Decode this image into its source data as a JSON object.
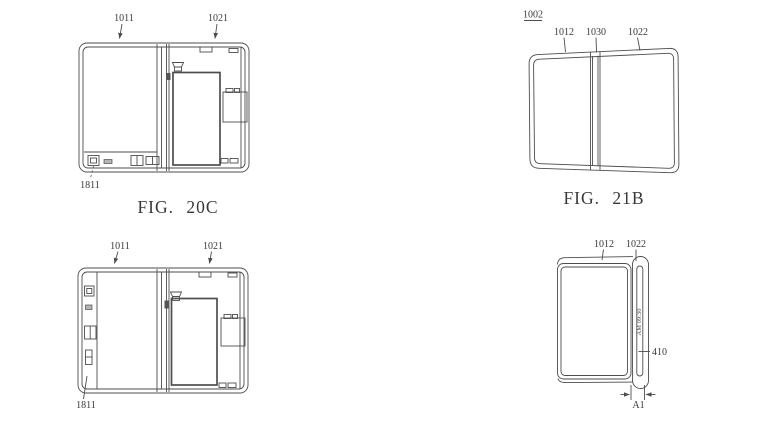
{
  "fig20c": {
    "caption": "FIG. 20C",
    "labels": {
      "l1011": "1011",
      "l1021": "1021",
      "l1811": "1811"
    }
  },
  "fig21b": {
    "caption": "FIG. 21B",
    "labels": {
      "l1002": "1002",
      "l1012": "1012",
      "l1030": "1030",
      "l1022": "1022"
    }
  },
  "figBL": {
    "labels": {
      "l1011": "1011",
      "l1021": "1021",
      "l1811": "1811"
    }
  },
  "figSide": {
    "labels": {
      "l1012": "1012",
      "l1022": "1022",
      "l410": "410",
      "lA1": "A1"
    },
    "edge_display_text": "AM 09:30"
  },
  "colors": {
    "line": "#4d4d4d",
    "text": "#383838",
    "background": "#ffffff"
  }
}
